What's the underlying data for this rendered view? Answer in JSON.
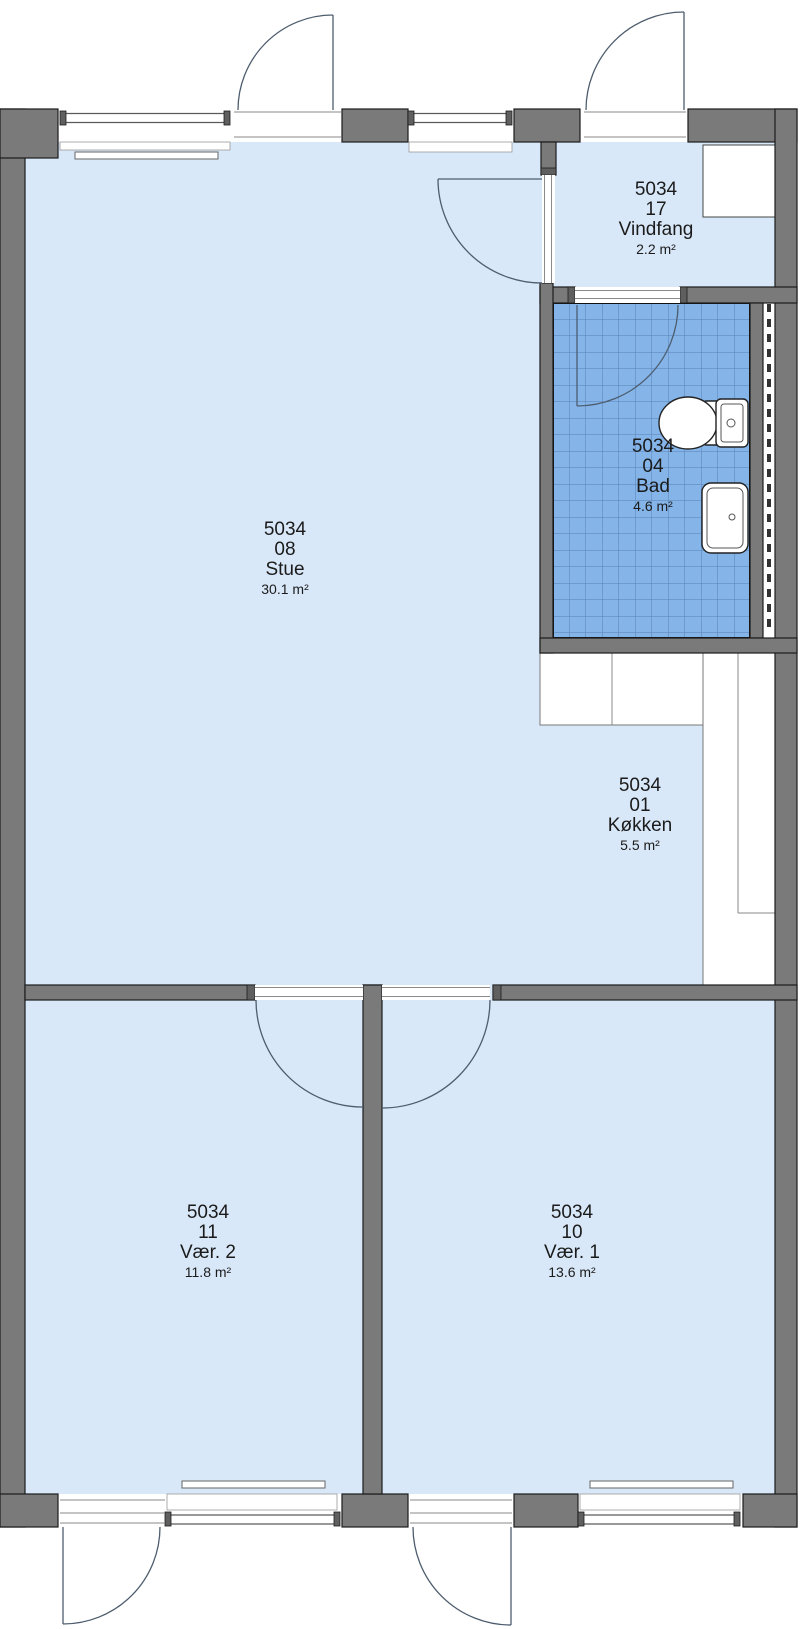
{
  "plan_title": "Apartment floor plan",
  "colors": {
    "wall": "#7a7a7a",
    "wall_dark": "#5f5f5f",
    "floor": "#d9e8f8",
    "tile": "#84b4e8",
    "outline": "#1c1c1c",
    "accent_line": "#4e5d6e"
  },
  "rooms": [
    {
      "id": "5034",
      "number": "08",
      "name": "Stue",
      "area": "30.1 m²"
    },
    {
      "id": "5034",
      "number": "17",
      "name": "Vindfang",
      "area": "2.2 m²"
    },
    {
      "id": "5034",
      "number": "04",
      "name": "Bad",
      "area": "4.6 m²"
    },
    {
      "id": "5034",
      "number": "01",
      "name": "Køkken",
      "area": "5.5 m²"
    },
    {
      "id": "5034",
      "number": "11",
      "name": "Vær. 2",
      "area": "11.8 m²"
    },
    {
      "id": "5034",
      "number": "10",
      "name": "Vær. 1",
      "area": "13.6 m²"
    }
  ],
  "icons": {
    "toilet": "toilet-icon",
    "sink": "sink-icon",
    "radiator": "radiator",
    "door_swing": "door-swing-arc"
  }
}
